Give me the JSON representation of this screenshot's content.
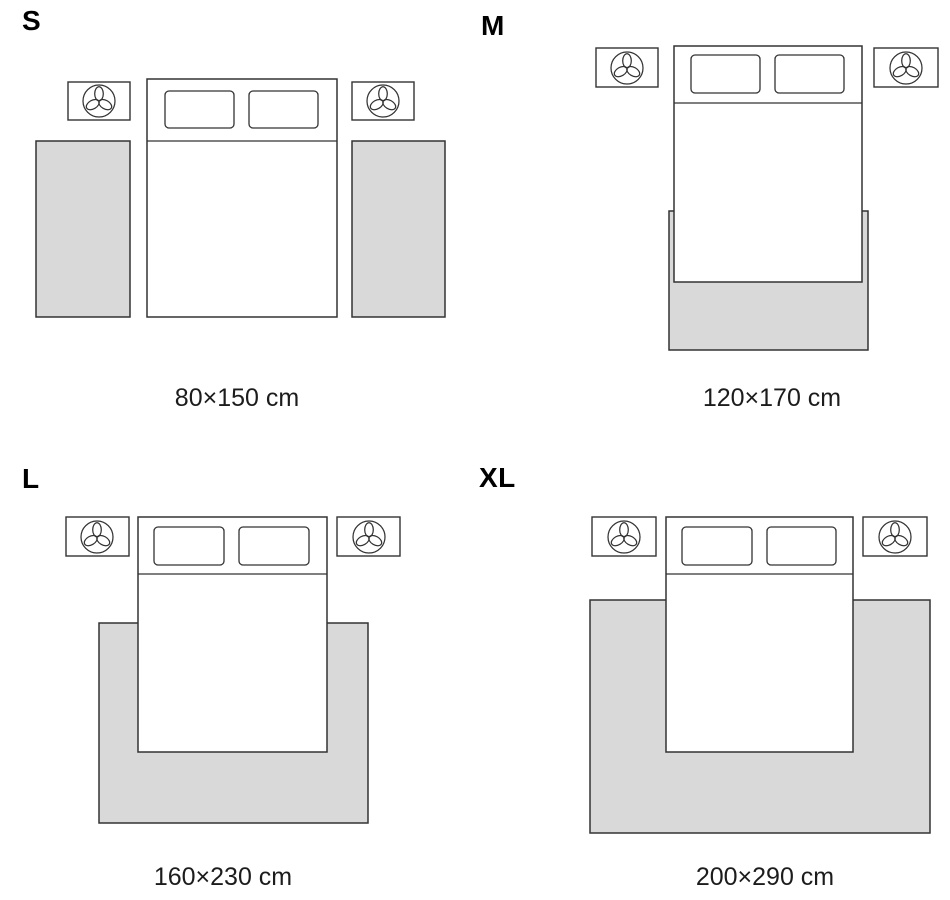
{
  "colors": {
    "background": "#ffffff",
    "rug_fill": "#d9d9d9",
    "outline": "#333333",
    "label_text": "#000000",
    "dimension_text": "#1c1c1c"
  },
  "icons": {
    "nightstand_decoration": "plant-icon"
  },
  "panels": [
    {
      "size": "S",
      "dimensions": "80×150 cm",
      "rug_placement": "two runner rugs beside the bed"
    },
    {
      "size": "M",
      "dimensions": "120×170 cm",
      "rug_placement": "rug under foot of bed"
    },
    {
      "size": "L",
      "dimensions": "160×230 cm",
      "rug_placement": "rug under bed extending at sides and foot"
    },
    {
      "size": "XL",
      "dimensions": "200×290 cm",
      "rug_placement": "wide rug under bed extending far at sides and foot"
    }
  ]
}
